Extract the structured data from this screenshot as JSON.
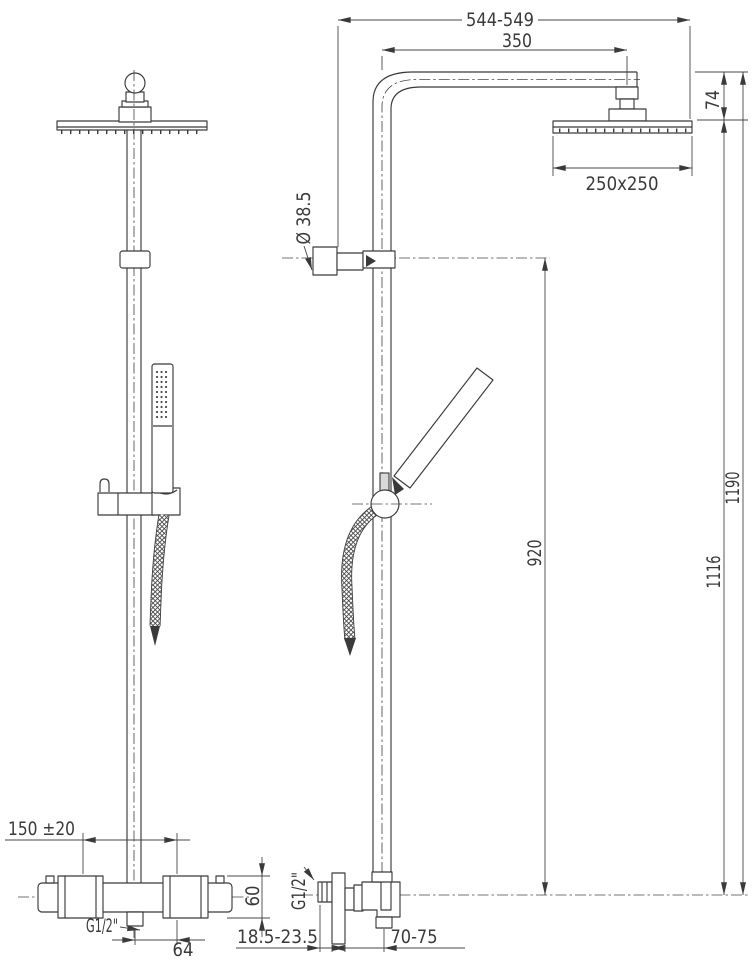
{
  "colors": {
    "line": "#3a3a3a",
    "dimension": "#474747",
    "background": "#ffffff"
  },
  "dims": {
    "top_width": "544-549",
    "arm_reach": "350",
    "head_drop": "74",
    "head_size": "250x250",
    "bracket_diameter": "Ø 38.5",
    "riser_height": "920",
    "height_head_bottom": "1116",
    "total_height": "1190",
    "inlet_spacing": "150 ±20",
    "outlet_thread": "G1/2\"",
    "outlet_offset": "64",
    "valve_height": "60",
    "wall_clearance": "18.5-23.5",
    "wall_thread": "G1/2\"",
    "outlet_depth": "70-75"
  }
}
